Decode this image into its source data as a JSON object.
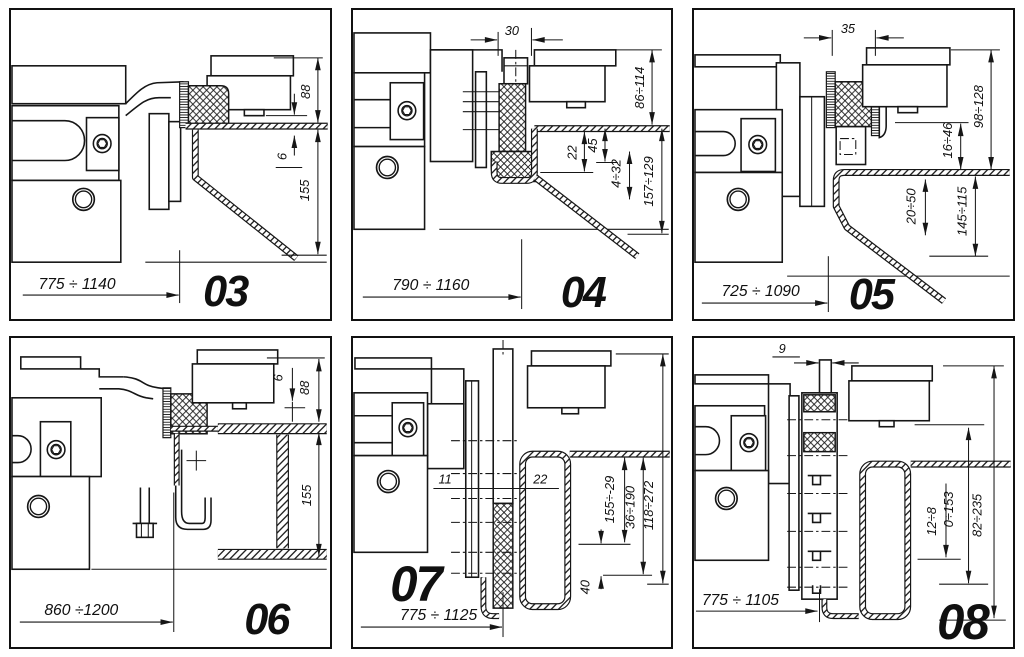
{
  "figure": {
    "background": "#ffffff",
    "line_color": "#161616",
    "description_labels": {
      "hatch_pad": "rubber-clamp-pad",
      "sheet": "sheet-metal-profile"
    },
    "panel_count": 6
  },
  "panels": [
    {
      "number": "03",
      "dims": {
        "a": "88",
        "b": "6",
        "c": "155",
        "bottom": "775 ÷ 1140"
      }
    },
    {
      "number": "04",
      "dims": {
        "top": "30",
        "a": "86÷114",
        "b": "22",
        "c": "45",
        "d": "4÷32",
        "e": "157÷129",
        "bottom": "790 ÷ 1160"
      }
    },
    {
      "number": "05",
      "dims": {
        "top": "35",
        "a": "98÷128",
        "b": "16÷46",
        "c": "20÷50",
        "d": "145÷115",
        "bottom": "725 ÷ 1090"
      }
    },
    {
      "number": "06",
      "dims": {
        "a": "6",
        "b": "88",
        "c": "155",
        "bottom": "860 ÷1200"
      }
    },
    {
      "number": "07",
      "dims": {
        "a": "11",
        "b": "22",
        "c": "155÷-29",
        "d": "36÷190",
        "e": "118÷272",
        "f": "40",
        "bottom": "775 ÷ 1125"
      }
    },
    {
      "number": "08",
      "dims": {
        "top": "9",
        "a": "12÷8",
        "b": "0÷153",
        "c": "82÷235",
        "bottom": "775 ÷ 1105"
      }
    }
  ]
}
